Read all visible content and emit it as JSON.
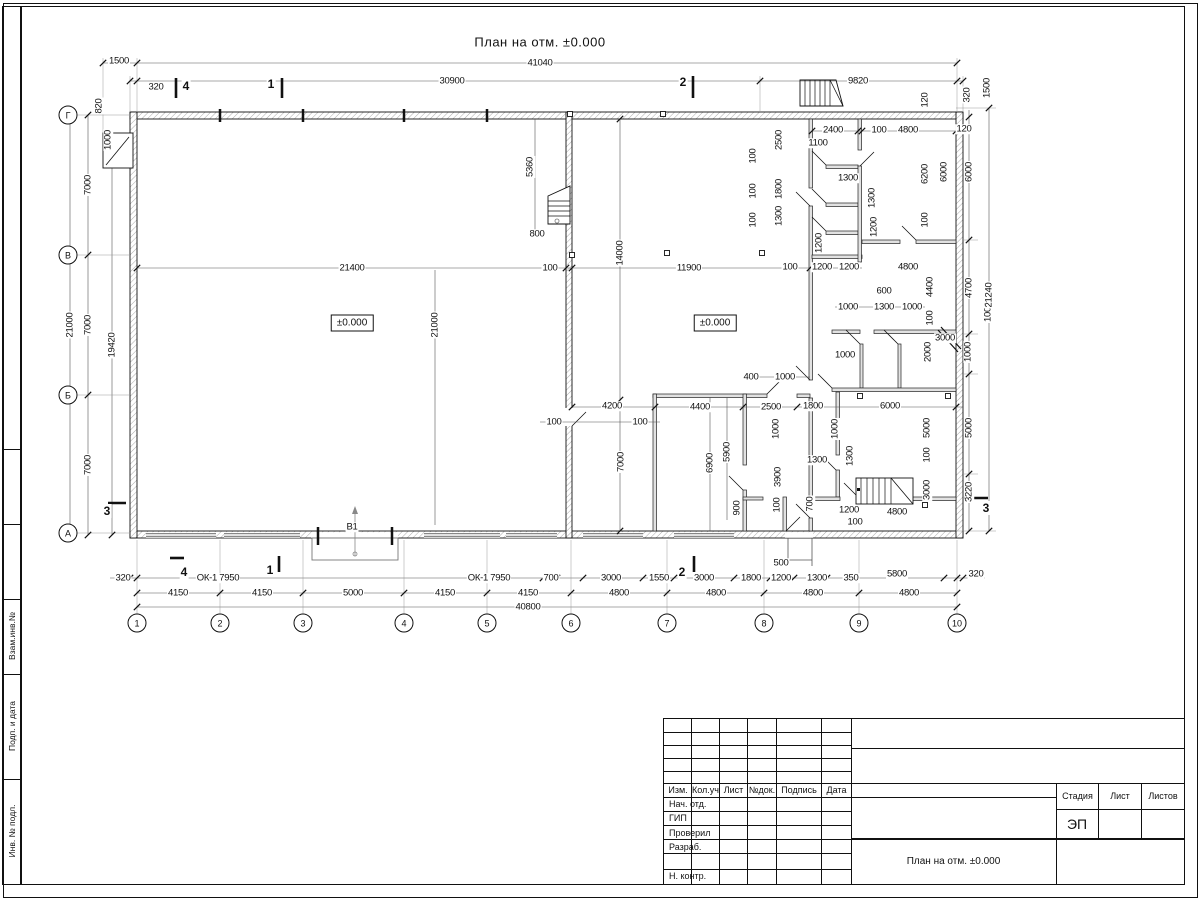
{
  "page_title": "План на отм. ±0.000",
  "doc": {
    "stage": "ЭП",
    "name": "План на отм. ±0.000"
  },
  "titleblock": {
    "header": [
      "Изм.",
      "Кол.уч",
      "Лист",
      "№док.",
      "Подпись",
      "Дата"
    ],
    "rows": [
      "Нач. отд.",
      "ГИП",
      "Проверил",
      "Разраб.",
      "",
      "Н. контр."
    ],
    "stage_cols": [
      "Стадия",
      "Лист",
      "Листов"
    ]
  },
  "frame_stamps": [
    "Взам.инв.№",
    "Подп. и дата",
    "Инв. № подл."
  ],
  "axes_bottom": [
    {
      "n": "1",
      "x": 137
    },
    {
      "n": "2",
      "x": 220
    },
    {
      "n": "3",
      "x": 303
    },
    {
      "n": "4",
      "x": 404
    },
    {
      "n": "5",
      "x": 487
    },
    {
      "n": "6",
      "x": 571
    },
    {
      "n": "7",
      "x": 667
    },
    {
      "n": "8",
      "x": 764
    },
    {
      "n": "9",
      "x": 859
    },
    {
      "n": "10",
      "x": 957
    }
  ],
  "axes_left": [
    {
      "n": "Г",
      "y": 115
    },
    {
      "n": "В",
      "y": 255
    },
    {
      "n": "Б",
      "y": 395
    },
    {
      "n": "А",
      "y": 533
    }
  ],
  "section_marks": [
    {
      "n": "4",
      "x": 186,
      "y": 86
    },
    {
      "n": "1",
      "x": 271,
      "y": 84
    },
    {
      "n": "2",
      "x": 683,
      "y": 82
    },
    {
      "n": "4",
      "x": 184,
      "y": 572
    },
    {
      "n": "1",
      "x": 270,
      "y": 570
    },
    {
      "n": "2",
      "x": 682,
      "y": 572
    },
    {
      "n": "3",
      "x": 107,
      "y": 511
    },
    {
      "n": "3",
      "x": 986,
      "y": 508
    }
  ],
  "level_marks": [
    {
      "t": "±0.000",
      "x": 352,
      "y": 323
    },
    {
      "t": "±0.000",
      "x": 715,
      "y": 323
    }
  ],
  "labels": [
    {
      "t": "41040",
      "x": 540,
      "y": 63,
      "v": 0
    },
    {
      "t": "1500",
      "x": 119,
      "y": 61,
      "v": 0
    },
    {
      "t": "320",
      "x": 156,
      "y": 87,
      "v": 0
    },
    {
      "t": "30900",
      "x": 452,
      "y": 81,
      "v": 0
    },
    {
      "t": "9820",
      "x": 858,
      "y": 81,
      "v": 0
    },
    {
      "t": "820",
      "x": 99,
      "y": 106,
      "v": 1
    },
    {
      "t": "1000",
      "x": 108,
      "y": 140,
      "v": 1
    },
    {
      "t": "320",
      "x": 967,
      "y": 95,
      "v": 1
    },
    {
      "t": "1500",
      "x": 987,
      "y": 88,
      "v": 1
    },
    {
      "t": "120",
      "x": 925,
      "y": 100,
      "v": 1
    },
    {
      "t": "2400",
      "x": 833,
      "y": 130,
      "v": 0
    },
    {
      "t": "100",
      "x": 879,
      "y": 130,
      "v": 0
    },
    {
      "t": "4800",
      "x": 908,
      "y": 130,
      "v": 0
    },
    {
      "t": "120",
      "x": 964,
      "y": 129,
      "v": 0
    },
    {
      "t": "1100",
      "x": 818,
      "y": 143,
      "v": 0
    },
    {
      "t": "2500",
      "x": 779,
      "y": 140,
      "v": 1
    },
    {
      "t": "100",
      "x": 753,
      "y": 156,
      "v": 1
    },
    {
      "t": "1800",
      "x": 779,
      "y": 189,
      "v": 1
    },
    {
      "t": "100",
      "x": 753,
      "y": 191,
      "v": 1
    },
    {
      "t": "1300",
      "x": 779,
      "y": 216,
      "v": 1
    },
    {
      "t": "100",
      "x": 753,
      "y": 220,
      "v": 1
    },
    {
      "t": "1300",
      "x": 848,
      "y": 178,
      "v": 0
    },
    {
      "t": "1300",
      "x": 872,
      "y": 198,
      "v": 1
    },
    {
      "t": "1200",
      "x": 874,
      "y": 227,
      "v": 1
    },
    {
      "t": "1200",
      "x": 819,
      "y": 243,
      "v": 1
    },
    {
      "t": "6200",
      "x": 925,
      "y": 174,
      "v": 1
    },
    {
      "t": "6000",
      "x": 944,
      "y": 172,
      "v": 1
    },
    {
      "t": "100",
      "x": 925,
      "y": 220,
      "v": 1
    },
    {
      "t": "1200",
      "x": 822,
      "y": 267,
      "v": 0
    },
    {
      "t": "1200",
      "x": 849,
      "y": 267,
      "v": 0
    },
    {
      "t": "4800",
      "x": 908,
      "y": 267,
      "v": 0
    },
    {
      "t": "600",
      "x": 884,
      "y": 291,
      "v": 0
    },
    {
      "t": "1000",
      "x": 848,
      "y": 307,
      "v": 0
    },
    {
      "t": "1300",
      "x": 884,
      "y": 307,
      "v": 0
    },
    {
      "t": "1000",
      "x": 912,
      "y": 307,
      "v": 0
    },
    {
      "t": "4400",
      "x": 930,
      "y": 287,
      "v": 1
    },
    {
      "t": "100",
      "x": 930,
      "y": 318,
      "v": 1
    },
    {
      "t": "3000",
      "x": 945,
      "y": 338,
      "v": 0
    },
    {
      "t": "1000",
      "x": 845,
      "y": 355,
      "v": 0
    },
    {
      "t": "2000",
      "x": 928,
      "y": 352,
      "v": 1
    },
    {
      "t": "1000",
      "x": 988,
      "y": 312,
      "v": 1
    },
    {
      "t": "1000",
      "x": 968,
      "y": 352,
      "v": 1
    },
    {
      "t": "4700",
      "x": 969,
      "y": 288,
      "v": 1
    },
    {
      "t": "21240",
      "x": 989,
      "y": 295,
      "v": 1
    },
    {
      "t": "6000",
      "x": 969,
      "y": 172,
      "v": 1
    },
    {
      "t": "5000",
      "x": 969,
      "y": 428,
      "v": 1
    },
    {
      "t": "3220",
      "x": 969,
      "y": 492,
      "v": 1
    },
    {
      "t": "1000",
      "x": 776,
      "y": 429,
      "v": 1
    },
    {
      "t": "1000",
      "x": 835,
      "y": 429,
      "v": 1
    },
    {
      "t": "3900",
      "x": 778,
      "y": 477,
      "v": 1
    },
    {
      "t": "100",
      "x": 777,
      "y": 505,
      "v": 1
    },
    {
      "t": "700",
      "x": 810,
      "y": 504,
      "v": 1
    },
    {
      "t": "1300",
      "x": 817,
      "y": 460,
      "v": 0
    },
    {
      "t": "1300",
      "x": 850,
      "y": 456,
      "v": 1
    },
    {
      "t": "1200",
      "x": 849,
      "y": 510,
      "v": 0
    },
    {
      "t": "100",
      "x": 855,
      "y": 522,
      "v": 0
    },
    {
      "t": "4800",
      "x": 897,
      "y": 512,
      "v": 0
    },
    {
      "t": "5000",
      "x": 927,
      "y": 428,
      "v": 1
    },
    {
      "t": "100",
      "x": 927,
      "y": 455,
      "v": 1
    },
    {
      "t": "3000",
      "x": 927,
      "y": 490,
      "v": 1
    },
    {
      "t": "2500",
      "x": 771,
      "y": 407,
      "v": 0
    },
    {
      "t": "1800",
      "x": 813,
      "y": 406,
      "v": 0
    },
    {
      "t": "6000",
      "x": 890,
      "y": 406,
      "v": 0
    },
    {
      "t": "4200",
      "x": 612,
      "y": 406,
      "v": 0
    },
    {
      "t": "4400",
      "x": 700,
      "y": 407,
      "v": 0
    },
    {
      "t": "400",
      "x": 751,
      "y": 377,
      "v": 0
    },
    {
      "t": "1000",
      "x": 785,
      "y": 377,
      "v": 0
    },
    {
      "t": "100",
      "x": 640,
      "y": 422,
      "v": 0
    },
    {
      "t": "100",
      "x": 554,
      "y": 422,
      "v": 0
    },
    {
      "t": "7000",
      "x": 621,
      "y": 462,
      "v": 1
    },
    {
      "t": "6900",
      "x": 710,
      "y": 463,
      "v": 1
    },
    {
      "t": "5900",
      "x": 727,
      "y": 452,
      "v": 1
    },
    {
      "t": "900",
      "x": 737,
      "y": 508,
      "v": 1
    },
    {
      "t": "21400",
      "x": 352,
      "y": 268,
      "v": 0
    },
    {
      "t": "100",
      "x": 550,
      "y": 268,
      "v": 0
    },
    {
      "t": "11900",
      "x": 689,
      "y": 268,
      "v": 0
    },
    {
      "t": "100",
      "x": 790,
      "y": 267,
      "v": 0
    },
    {
      "t": "14000",
      "x": 620,
      "y": 253,
      "v": 1
    },
    {
      "t": "21000",
      "x": 435,
      "y": 325,
      "v": 1
    },
    {
      "t": "5360",
      "x": 530,
      "y": 167,
      "v": 1
    },
    {
      "t": "800",
      "x": 537,
      "y": 234,
      "v": 0
    },
    {
      "t": "7000",
      "x": 88,
      "y": 185,
      "v": 1
    },
    {
      "t": "7000",
      "x": 88,
      "y": 325,
      "v": 1
    },
    {
      "t": "7000",
      "x": 88,
      "y": 465,
      "v": 1
    },
    {
      "t": "21000",
      "x": 70,
      "y": 325,
      "v": 1
    },
    {
      "t": "19420",
      "x": 112,
      "y": 345,
      "v": 1
    },
    {
      "t": "320",
      "x": 123,
      "y": 578,
      "v": 0
    },
    {
      "t": "ОК-1 7950",
      "x": 218,
      "y": 578,
      "v": 0
    },
    {
      "t": "ОК-1 7950",
      "x": 489,
      "y": 578,
      "v": 0
    },
    {
      "t": "700",
      "x": 551,
      "y": 578,
      "v": 0
    },
    {
      "t": "3000",
      "x": 611,
      "y": 578,
      "v": 0
    },
    {
      "t": "1550",
      "x": 659,
      "y": 578,
      "v": 0
    },
    {
      "t": "3000",
      "x": 704,
      "y": 578,
      "v": 0
    },
    {
      "t": "1800",
      "x": 751,
      "y": 578,
      "v": 0
    },
    {
      "t": "1200",
      "x": 781,
      "y": 578,
      "v": 0
    },
    {
      "t": "1300",
      "x": 817,
      "y": 578,
      "v": 0
    },
    {
      "t": "350",
      "x": 851,
      "y": 578,
      "v": 0
    },
    {
      "t": "5800",
      "x": 897,
      "y": 574,
      "v": 0
    },
    {
      "t": "320",
      "x": 976,
      "y": 574,
      "v": 0
    },
    {
      "t": "500",
      "x": 781,
      "y": 563,
      "v": 0
    },
    {
      "t": "4150",
      "x": 178,
      "y": 593,
      "v": 0
    },
    {
      "t": "4150",
      "x": 262,
      "y": 593,
      "v": 0
    },
    {
      "t": "5000",
      "x": 353,
      "y": 593,
      "v": 0
    },
    {
      "t": "4150",
      "x": 445,
      "y": 593,
      "v": 0
    },
    {
      "t": "4150",
      "x": 528,
      "y": 593,
      "v": 0
    },
    {
      "t": "4800",
      "x": 619,
      "y": 593,
      "v": 0
    },
    {
      "t": "4800",
      "x": 716,
      "y": 593,
      "v": 0
    },
    {
      "t": "4800",
      "x": 813,
      "y": 593,
      "v": 0
    },
    {
      "t": "4800",
      "x": 909,
      "y": 593,
      "v": 0
    },
    {
      "t": "40800",
      "x": 528,
      "y": 607,
      "v": 0
    },
    {
      "t": "В1",
      "x": 352,
      "y": 527,
      "v": 0
    }
  ]
}
